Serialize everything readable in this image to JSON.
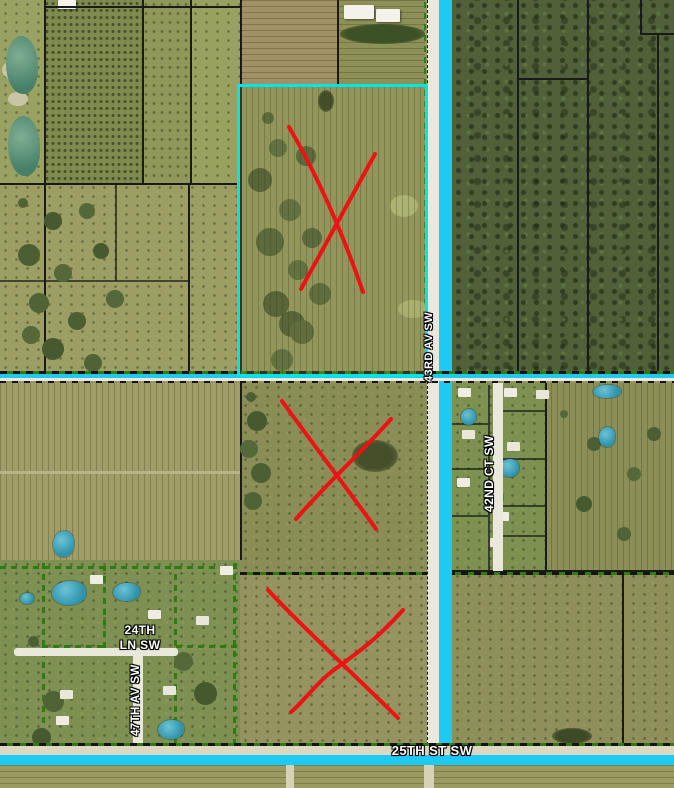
{
  "title": "Aerial parcel map with highlighted roads and marked parcels",
  "labels": {
    "road_43rd": "43RD AV SW",
    "road_42nd": "42ND CT SW",
    "road_47th": "47TH AV SW",
    "road_25th": "25TH ST SW",
    "road_24th_line1": "24TH",
    "road_24th_line2": "LN SW"
  },
  "features": {
    "x_mark_count": 3,
    "highlighted_parcel_count": 1
  },
  "colors": {
    "road_highlight": "#1ec9f2",
    "selected_parcel_outline": "#00e6e6",
    "x_mark": "#ee1313",
    "parcel_line_green": "#2f7d12",
    "parcel_line_black": "#1a1a1a",
    "road_surface": "#eae7db",
    "pond": "#2e93ad",
    "label_text": "#ffffff"
  }
}
